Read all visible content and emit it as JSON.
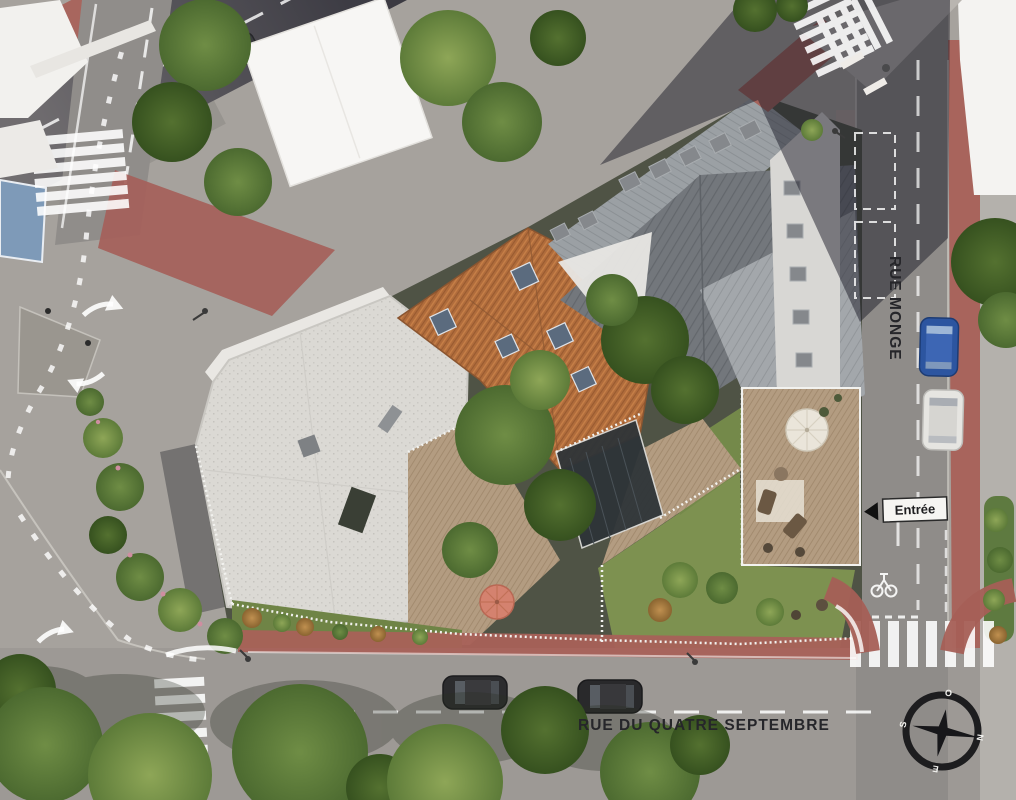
{
  "scene_title": "Aerial architectural site plan rendering",
  "labels": {
    "street_right": "RUE MONGE",
    "street_bottom": "RUE DU QUATRE SEPTEMBRE",
    "entrance": "Entrée"
  },
  "compass": {
    "north": "N",
    "south": "S",
    "east": "E",
    "west": "O"
  },
  "palette": {
    "asphalt": "#a6a29d",
    "road_shadow": "#31303a",
    "brick_paving": "#a86159",
    "roof_white_gravel": "#dcdad5",
    "roof_tile_orange": "#b06c3c",
    "roof_metal_dark": "#73777c",
    "roof_metal_light": "#a3a7ab",
    "lawn_green": "#7d9150",
    "tree_green": "#5c7a38",
    "deck_wood": "#b39c81",
    "road_marking": "#ffffff",
    "car_blue": "#2c55a0",
    "car_white": "#e6e5e1",
    "umbrella_red": "#d4826f",
    "umbrella_white": "#eae5da",
    "bus_lane_blue": "#7e9ab8"
  },
  "vehicles": [
    {
      "type": "car",
      "color_name": "dark-gray",
      "street": "top road"
    },
    {
      "type": "car",
      "color_name": "blue",
      "street": "Rue Monge"
    },
    {
      "type": "car",
      "color_name": "white",
      "street": "Rue Monge"
    },
    {
      "type": "car",
      "color_name": "dark",
      "street": "Rue du Quatre Septembre"
    },
    {
      "type": "car",
      "color_name": "dark",
      "street": "Rue du Quatre Septembre"
    }
  ]
}
